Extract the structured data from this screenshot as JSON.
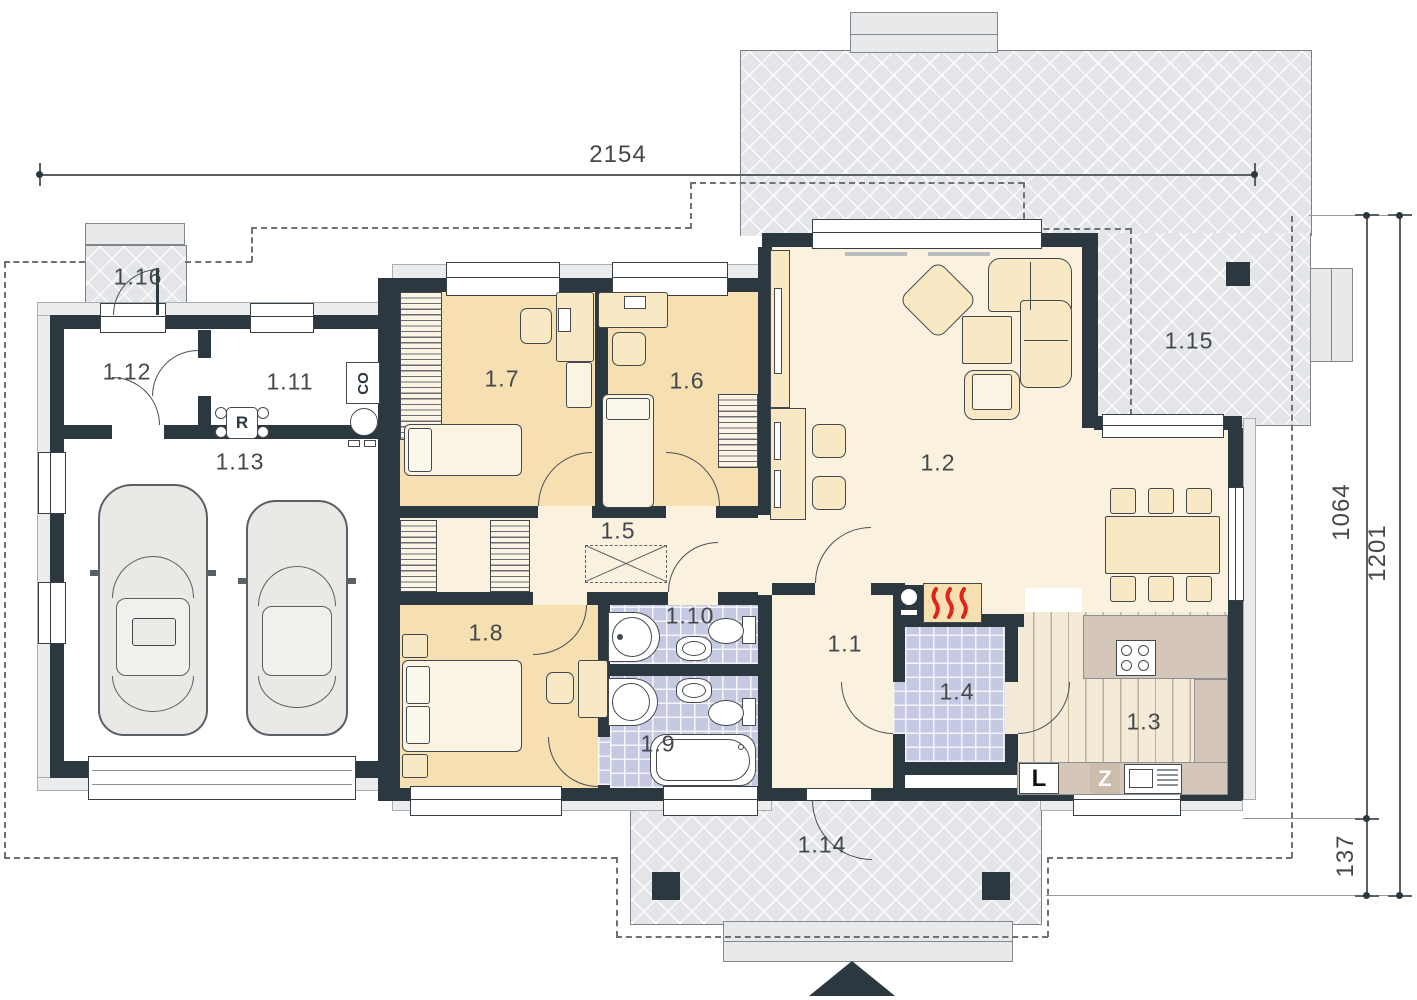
{
  "dimensions": {
    "top": "2154",
    "right_inner": "1064",
    "right_outer": "1201",
    "bottom_right": "137"
  },
  "rooms": {
    "r1_1": "1.1",
    "r1_2": "1.2",
    "r1_3": "1.3",
    "r1_4": "1.4",
    "r1_5": "1.5",
    "r1_6": "1.6",
    "r1_7": "1.7",
    "r1_8": "1.8",
    "r1_9": "1.9",
    "r1_10": "1.10",
    "r1_11": "1.11",
    "r1_12": "1.12",
    "r1_13": "1.13",
    "r1_14": "1.14",
    "r1_15": "1.15",
    "r1_16": "1.16"
  },
  "equipment": {
    "boiler": "CO",
    "heating_manifold": "R",
    "fridge": "L",
    "dishwasher": "Z"
  },
  "colors": {
    "wall": "#2c3840",
    "bedroom_floor": "#f6dfb0",
    "main_floor": "#faf2df",
    "bathroom_tile": "#c6c9e2",
    "terrace": "#e3e5e8",
    "counter": "#d4c6b8",
    "flame": "#e02418"
  }
}
